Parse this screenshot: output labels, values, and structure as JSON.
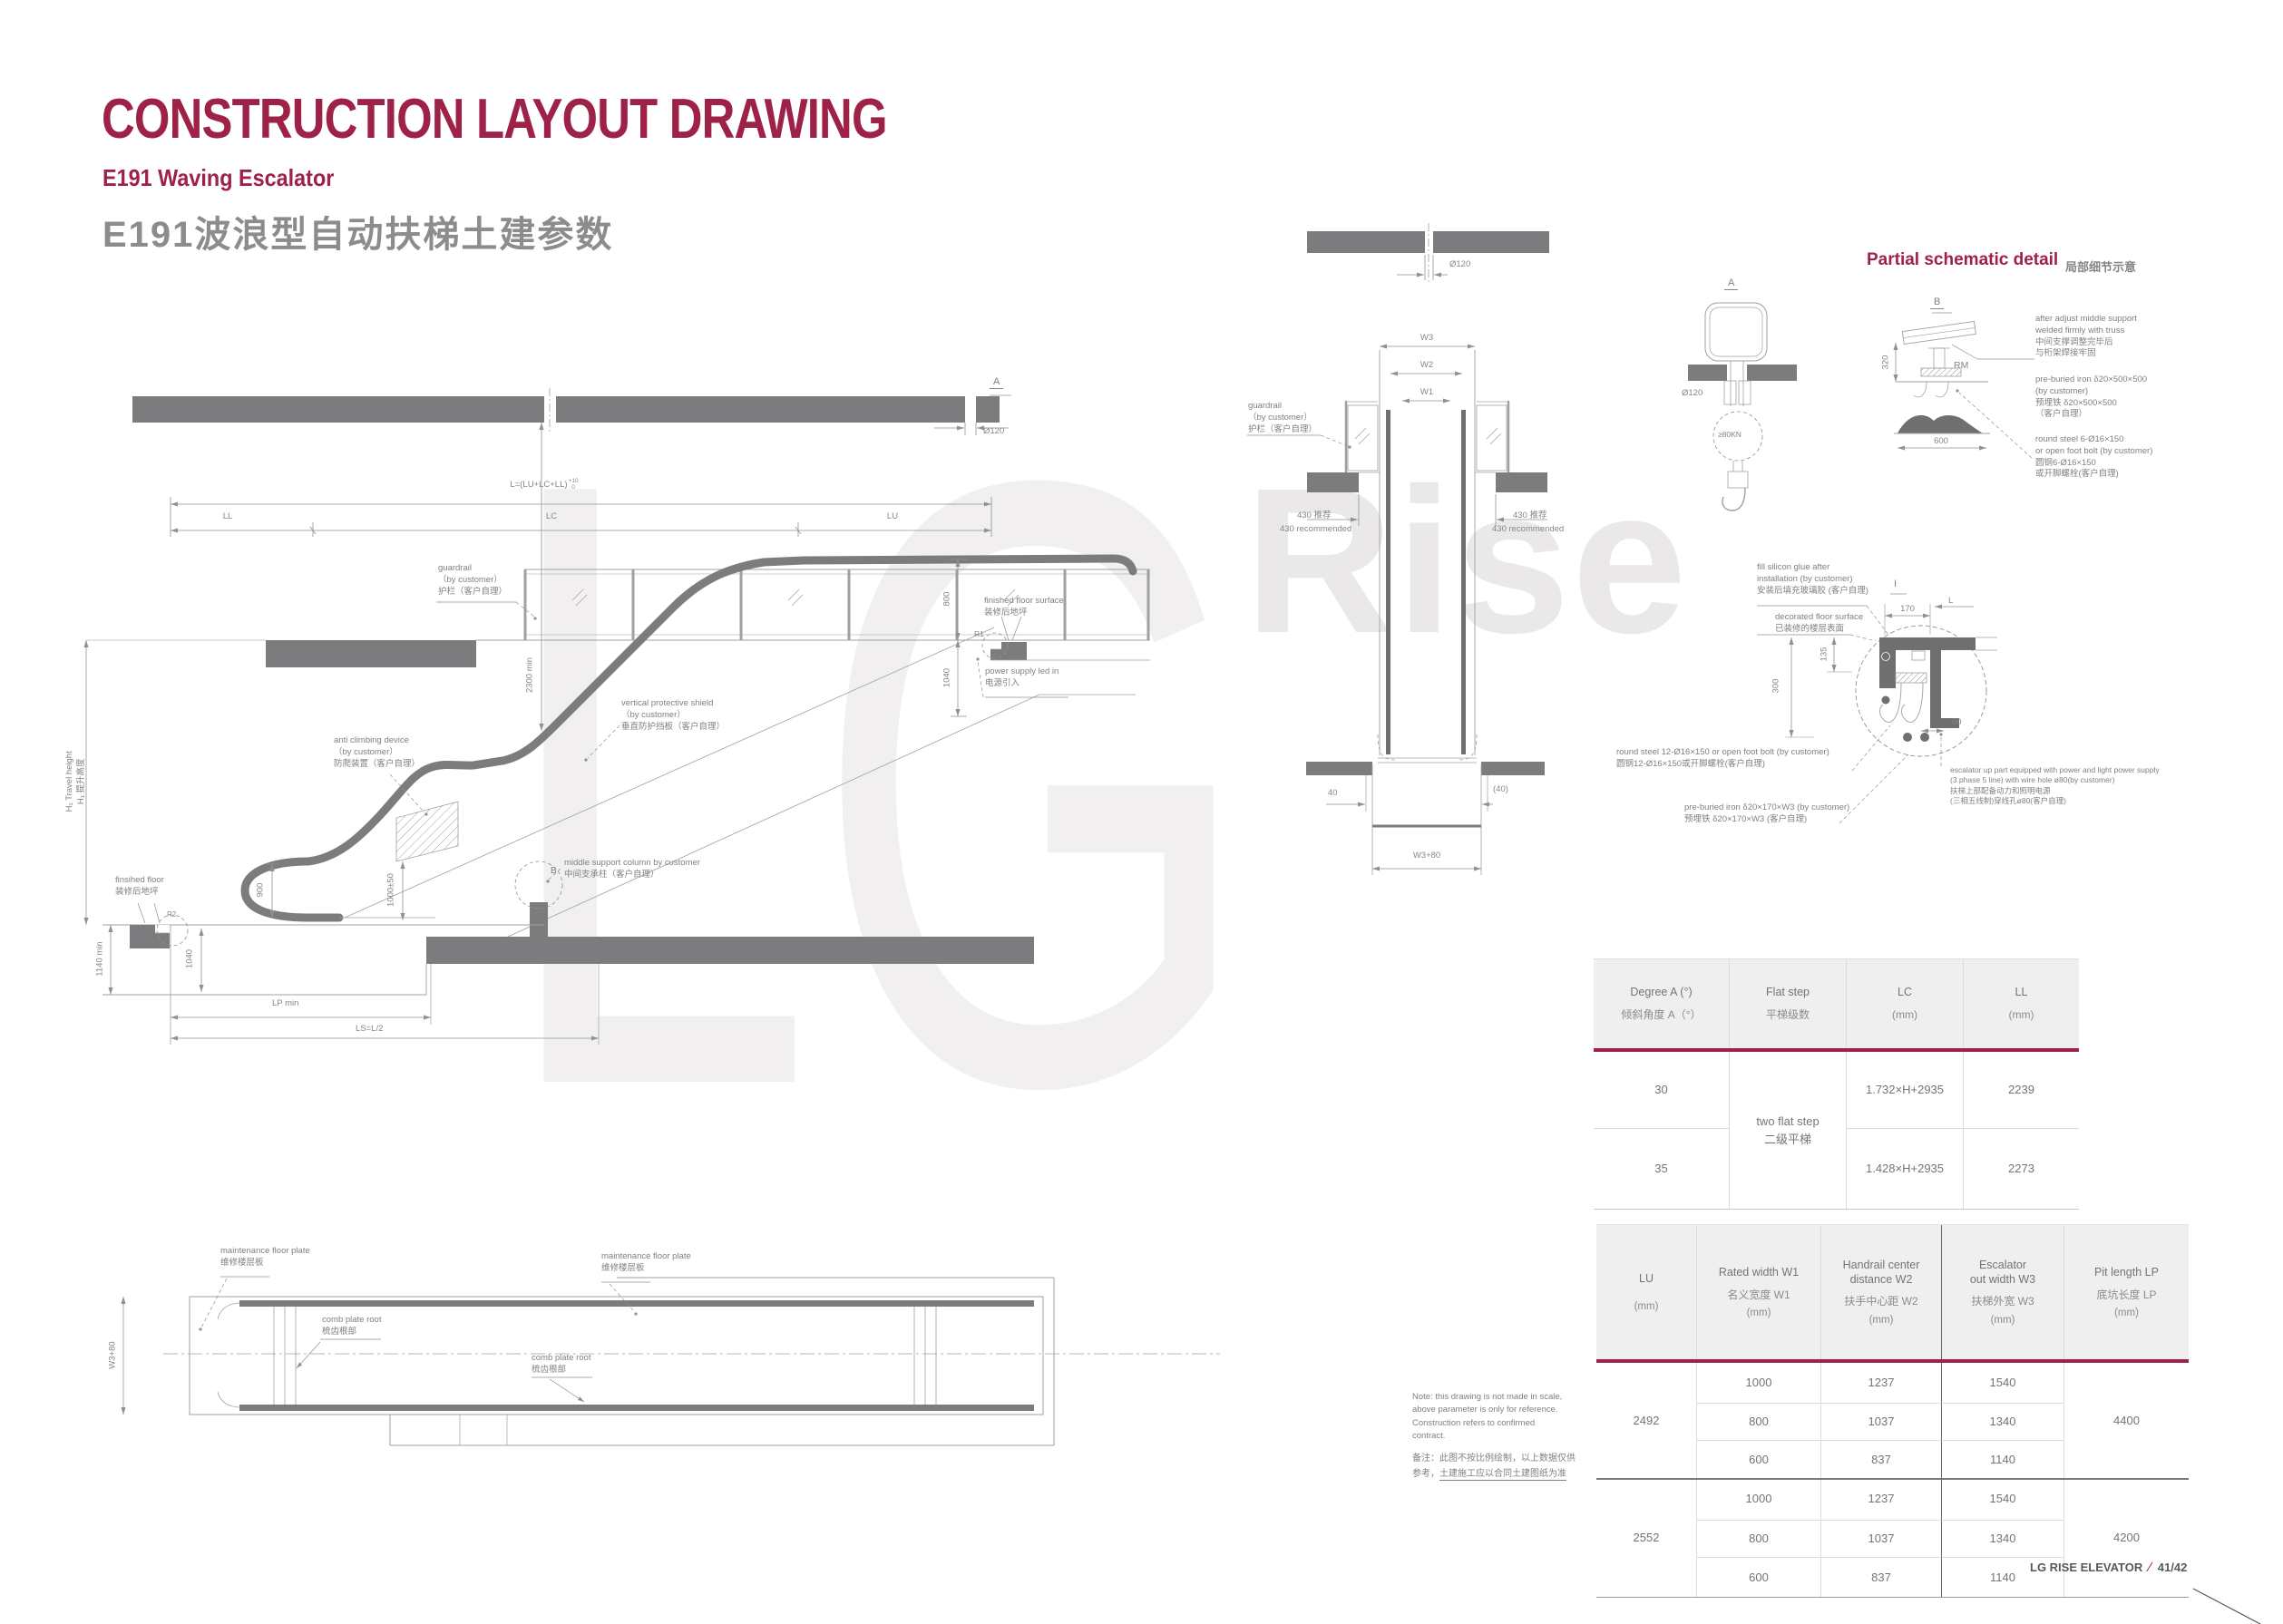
{
  "header": {
    "title": "CONSTRUCTION LAYOUT DRAWING",
    "subtitle_en": "E191 Waving Escalator",
    "subtitle_cn": "E191波浪型自动扶梯土建参数"
  },
  "watermark": {
    "word1": "LG",
    "word2": "Rise"
  },
  "colors": {
    "accent": "#9E2148",
    "beam": "#7c7c7f",
    "line": "#9fa0a2"
  },
  "elev": {
    "formula": "L=(LU+LC+LL)",
    "tol_top": "+10",
    "tol_bot": "0",
    "ll": "LL",
    "lc": "LC",
    "lu": "LU",
    "a_mark": "A",
    "dia": "Ø120",
    "guardrail": [
      "guardrail",
      "（by customer）",
      "护栏（客户自理）"
    ],
    "ffs": [
      "finished floor surface",
      "装修后地坪"
    ],
    "r1": "R1",
    "power": [
      "power supply led in",
      "电源引入"
    ],
    "shield": [
      "vertical protective shield",
      "（by customer）",
      "垂直防护挡板（客户自理）"
    ],
    "anti": [
      "anti climbing device",
      "（by customer）",
      "防爬装置（客户自理）"
    ],
    "mid": [
      "middle support column by customer",
      "中间支承柱（客户自理）"
    ],
    "b_mark": "B",
    "dim_2300": "2300  min",
    "dim_1000": "1000±50",
    "dim_900": "900",
    "dim_800": "800",
    "dim_1040r": "1040",
    "travel": [
      "H₁ Travel height",
      "H₁ 提升高度"
    ],
    "ff": [
      "finsihed floor",
      "装修后地坪"
    ],
    "r2": "R2",
    "dim_1140": "1140  min",
    "dim_1040l": "1040",
    "dim_lp": "LP min",
    "dim_ls": "LS=L/2"
  },
  "plan": {
    "maint": [
      "maintenance floor plate",
      "维修楼层板"
    ],
    "comb": [
      "comb plate root",
      "梳齿根部"
    ],
    "dim_w380": "W3+80"
  },
  "section": {
    "dia": "Ø120",
    "w3": "W3",
    "w2": "W2",
    "w1": "W1",
    "guardrail": [
      "guardrail",
      "（by customer）",
      "护栏（客户自理）"
    ],
    "rec_cn": "430 推荐",
    "rec_en": "430 recommended",
    "dim_40": "40",
    "dim_40b": "(40)",
    "dim_w380": "W3+80"
  },
  "detail": {
    "title": "Partial schematic detail",
    "title_cn": "局部细节示意",
    "a_mark": "A",
    "a_dia": "Ø120",
    "a_load": "≥80KN",
    "b_mark": "B",
    "rm": "RM",
    "dim_320": "320",
    "dim_600": "600",
    "weld": [
      "after adjust middle support",
      "welded firmly with truss",
      "中间支撑调整完毕后",
      "与桁架焊接牢固"
    ],
    "iron": [
      "pre-buried iron δ20×500×500",
      "(by customer)",
      "预埋铁 δ20×500×500",
      "（客户自理）"
    ],
    "steel": [
      "round steel 6-Ø16×150",
      "or open foot bolt (by customer)",
      "圆钢6-Ø16×150",
      "或开脚螺栓(客户自理)"
    ]
  },
  "detail_i": {
    "i_mark": "I",
    "l_mark": "L",
    "dim_170": "170",
    "dim_135": "135",
    "dim_300": "300",
    "dim_50": "50",
    "glue": [
      "fill silicon glue after",
      "installation (by customer)",
      "安装后填充玻璃胶 (客户自理)"
    ],
    "floor": [
      "decorated floor surface",
      "已装修的楼层表面"
    ],
    "steel": [
      "round steel 12-Ø16×150 or open foot bolt (by customer)",
      "圆钢12-Ø16×150或开脚螺栓(客户自理)"
    ],
    "iron": [
      "pre-buried iron  δ20×170×W3 (by customer)",
      "预埋铁 δ20×170×W3 (客户自理)"
    ],
    "power": [
      "escalator up part equipped with power and light power supply",
      "(3 phase 5 line) with wire hole ø80(by customer)",
      "扶梯上部配备动力和照明电源",
      "(三相五线制)穿线孔ø80(客户自理)"
    ]
  },
  "t1": {
    "h": [
      {
        "en": "Degree A (°)",
        "cn": "倾斜角度 A（°）"
      },
      {
        "en": "Flat step",
        "cn": "平梯级数"
      },
      {
        "en": "LC",
        "cn": "(mm)"
      },
      {
        "en": "LL",
        "cn": "(mm)"
      }
    ],
    "r30": "30",
    "r35": "35",
    "flat_en": "two flat step",
    "flat_cn": "二级平梯",
    "lc30": "1.732×H+2935",
    "lc35": "1.428×H+2935",
    "ll30": "2239",
    "ll35": "2273"
  },
  "t2": {
    "h": [
      {
        "en1": "LU",
        "en2": "",
        "cn": "",
        "mm": "(mm)"
      },
      {
        "en1": "Rated width W1",
        "en2": "",
        "cn": "名义宽度 W1",
        "mm": "(mm)"
      },
      {
        "en1": "Handrail center",
        "en2": "distance W2",
        "cn": "扶手中心距 W2",
        "mm": "(mm)"
      },
      {
        "en1": "Escalator",
        "en2": "out width W3",
        "cn": "扶梯外宽 W3",
        "mm": "(mm)"
      },
      {
        "en1": "Pit length  LP",
        "en2": "",
        "cn": "底坑长度 LP",
        "mm": "(mm)"
      }
    ],
    "g1": {
      "lu": "2492",
      "lp": "4400",
      "rows": [
        [
          "1000",
          "1237",
          "1540"
        ],
        [
          "800",
          "1037",
          "1340"
        ],
        [
          "600",
          "837",
          "1140"
        ]
      ]
    },
    "g2": {
      "lu": "2552",
      "lp": "4200",
      "rows": [
        [
          "1000",
          "1237",
          "1540"
        ],
        [
          "800",
          "1037",
          "1340"
        ],
        [
          "600",
          "837",
          "1140"
        ]
      ]
    }
  },
  "note": {
    "en": [
      "Note: this drawing is not made in scale,",
      "above parameter is only for reference.",
      "Construction refers to confirmed",
      "contract."
    ],
    "cn1": "备注：此图不按比例绘制，以上数据仅供",
    "cn2a": "参考，",
    "cn2b": "土建施工应以合同土建图纸为准"
  },
  "footer": {
    "brand": "LG RISE ELEVATOR",
    "slash": "∕",
    "page": "41/42"
  }
}
